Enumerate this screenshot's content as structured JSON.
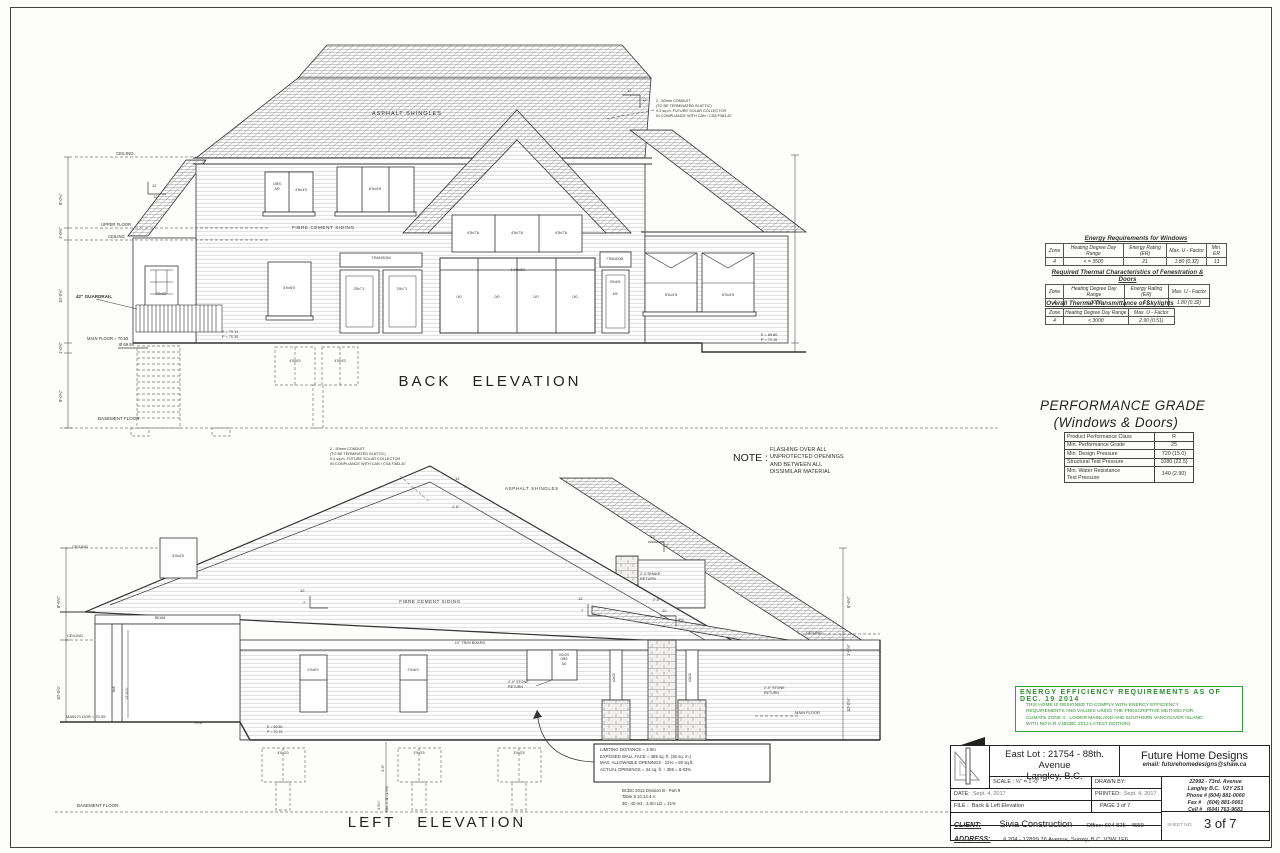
{
  "sheet": {
    "back_title": "BACK  ELEVATION",
    "left_title": "LEFT  ELEVATION"
  },
  "note": {
    "label": "NOTE :",
    "body": "FLASHING OVER ALL\nUNPROTECTED OPENINGS\nAND BETWEEN ALL\nDISSIMILAR MATERIAL"
  },
  "conduit_note": "2 - 50mm CONDUIT\n(TO BE TERMINATED IN ATTIC)\n9.3 sq.m. FUTURE SOLAR COLLECTOR\nIN COMPLIANCE WITH CAN / CSA F383-87",
  "back": {
    "asphalt": "ASPHALT SHINGLES",
    "siding": "FIBRE CEMENT SIDING",
    "ceiling": "CEILING",
    "upper_floor": "UPPER FLOOR",
    "ceiling2": "CEILING",
    "guardrail": "42\" GUARDRAIL",
    "main_floor": "MAIN FLOOR = 70.55",
    "grade_mark": "Ø 69.95",
    "basement_floor": "BASEMENT FLOOR",
    "ep_left": "E = 70.14\nP = 70.30",
    "ep_right": "E = 69.80\nP = 70.10",
    "dim1": "8'-0¼\"",
    "dim2": "1'-0¾\"",
    "dim3": "10'-0⅝\"",
    "dim4": "1'-0¾\"",
    "dim5": "9'-0¼\"",
    "pitch12": "12",
    "win_obs": "OBS\n3/0",
    "win_46x40": "4'6x4'0",
    "win_80x46": "8'0x4'6",
    "win_gable": "4'5x7'6",
    "door_main": "14'0x8'0",
    "door_panel": "0/0",
    "transom": "TRANSOM",
    "win_30x50": "3'0x5'0",
    "door_28x71": "2'8x7'1",
    "door_30x65": "3'0x6'5",
    "door_45": "4/5",
    "win_50x45": "5'0x4'5",
    "door_porch": "2'8x6'5",
    "win_base": "4'0x4'0"
  },
  "left": {
    "asphalt": "ASPHALT SHINGLES",
    "siding": "FIBRE CEMENT SIDING",
    "trim": "10\" TRIM BOARD",
    "beam": "BEAM",
    "shake_return": "2'-0\"SHAKE\nRETURN",
    "shake_dim": "2'-0\"",
    "stone_return": "2'-0\" STONE\nRETURN",
    "ceiling": "CEILING",
    "main_floor_left": "MAIN FLOOR = 70.55",
    "main_floor_right": "MAIN FLOOR",
    "basement_floor": "BASEMENT FLOOR",
    "ep": "E = 69.80\nP = 70.15",
    "spot": "70.47",
    "one_six": "1'-6\"",
    "win_upper": "4'0x4'0",
    "win_20x60": "2'0x6'0",
    "win_small": "3'0x2'0\nOBS\n3/0",
    "well1": "4'0x3'0",
    "well2": "3'9x3'5",
    "well3": "3'9x3'5",
    "post": "8x8",
    "post_porch": "10x10",
    "dim_867": "8'-6¾\"",
    "dim_1058": "10'-0⅝\"",
    "dim_108": "1'-0⅝\"",
    "dim_1268": "12'-6⅞\"",
    "dim_30": "3'-0\"",
    "dim_463": "4'-6¾\"",
    "dim_max": "Max. 4'-11\" (1.5m)",
    "pitch12": "12",
    "pitch7": "7",
    "pitch2": "2",
    "pitch45": "4½"
  },
  "limiting": {
    "box": "LIMITING DISTANCE = 3.0m\nEXPOSED WALL FACE = 385 sq. ft. (36 sq. m.)\nMAX. ALLOWABLE OPENINGS : 21% = 80 sq.ft.\nACTUAL OPENINGS = 34 sq. ft. ÷ 385 = 8.83%",
    "code": "BCBC 2012 Division B - Part 9\nTable 9.10.14.4.A\n30 - 40 m2,  3.0m LD = 21%"
  },
  "tables": {
    "windows": {
      "title": "Energy Requirements for Windows",
      "h": [
        "Zone",
        "Heating Degree Day Range",
        "Energy Rating (ER)",
        "Max. U - Factor",
        "Min. ER"
      ],
      "r": [
        "4",
        "< = 3500",
        "21",
        "1.80 (0.32)",
        "13"
      ]
    },
    "fenestration": {
      "title": "Required Thermal Characteristics  of Fenestration & Doors",
      "h": [
        "Zone",
        "Heating Degree Day Range",
        "Energy Rating (ER)",
        "Max. U - Factor"
      ],
      "r": [
        "4",
        "< 3000",
        "21",
        "1.80 (0.32)"
      ]
    },
    "skylights": {
      "title": "Overall Thermal Transmittance of Skylights",
      "h": [
        "Zone",
        "Heating Degree Day Range",
        "Max. U - Factor"
      ],
      "r": [
        "4",
        "< 3000",
        "2.90 (0.51)"
      ]
    }
  },
  "performance": {
    "title1": "PERFORMANCE GRADE",
    "title2": "(Windows & Doors)",
    "rows": [
      [
        "Product Performance Class",
        "R"
      ],
      [
        "Min. Performance Grade",
        "25"
      ],
      [
        "Min. Design Pressure",
        "720 (15.0)"
      ],
      [
        "Structural Test Pressure",
        "1080 (22.5)"
      ],
      [
        "Min. Water Resistance\nTest Pressure",
        "140 (2.90)"
      ]
    ]
  },
  "energy_box": {
    "title": "ENERGY EFFICIENCY REQUIREMENTS AS OF DEC. 19 2014",
    "body": "THIS HOME IS DESIGNED TO COMPLY WITH ENERGY EFFICIENCY\nREQUIREMENTS AND VALUES USING THE PRESCRIPTIVE METHOD FOR\nCLIMATE ZONE 4 - LOWER MAINLAND AND SOUTHERN VANCOUVER ISLAND\nWITH NO H.R.V.(BCBC 2012 LATEST EDITION)"
  },
  "title_block": {
    "project1": "East Lot : 21754 - 88th. Avenue",
    "project2": "Langley, B.C.",
    "company": "Future Home Designs",
    "email": "email: futurehomedesigns@shaw.ca",
    "scale": "SCALE : ¼\" = 1'-0\"",
    "drawn_by": "DRAWN BY:",
    "date_label": "DATE:",
    "date": "Sept. 4, 2017",
    "printed_label": "PRINTED:",
    "printed": "Sept. 4, 2017",
    "file_label": "FILE :",
    "file": "Back & Left Elevation",
    "page": "PAGE 3 of 7",
    "client_label": "CLIENT:",
    "client": "Sivia  Construction",
    "office": "Office: 604  825 - 4559",
    "address_label": "ADDRESS:",
    "address": "# 204 - 12899  76 Avenue, Surrey, B.C.  V3W 1E6",
    "addr": "22992 - 73rd. Avenue\nLangley B.C.  V2Y 2S1\nPhone # (604) 881-0060\nFax #    (604) 881-0061\nCell #   (604) 763-9683",
    "sheet_label": "SHEET NO.",
    "sheet": "3 of 7"
  }
}
